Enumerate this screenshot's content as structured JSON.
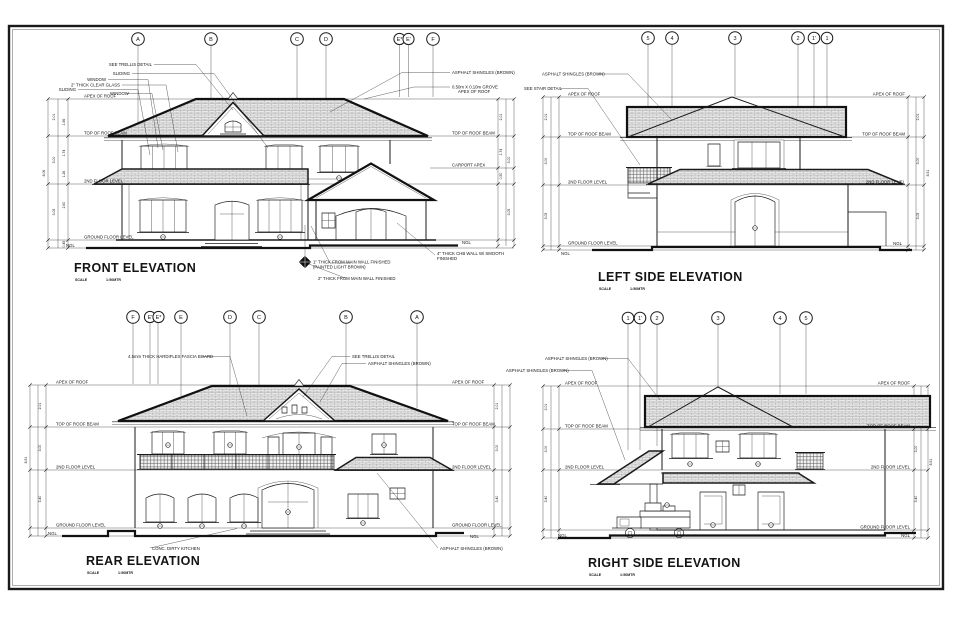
{
  "sheet": {
    "paper_color": "#ffffff",
    "line_color": "#1a1a1a"
  },
  "levels": {
    "apex_of_roof": "APEX OF ROOF",
    "top_of_roof_beam": "TOP OF ROOF BEAM",
    "carport_apex": "CARPORT APEX",
    "second_floor_level": "2ND FLOOR LEVEL",
    "ground_floor_level": "GROUND FLOOR LEVEL",
    "ngl": "NGL"
  },
  "notes": {
    "asphalt_shingles": "ASPHALT SHINGLES (BROWN)",
    "see_trellis": "SEE TRELLIS DETAIL",
    "see_stair": "SEE STAIR DETAIL",
    "sliding": "SLIDING",
    "window": "WINDOW",
    "clear_glass": "2\" THICK CLEAR GLASS",
    "grove": "0.50m X 0.10m GROVE",
    "grove_apex": "APEX OF ROOF",
    "fascia_board": "4.5mm THICK HARDIFLEX FASCIA BOARD",
    "dirty_kitchen": "CONC. DIRTY KITCHEN",
    "wall_note_1a": "1\" THICK FROM MAIN WALL FINISHED",
    "wall_note_1b": "(PAINTED LIGHT BROWN)",
    "wall_note_4a": "4\" THICK CHB WALL W/ SMOOTH",
    "wall_note_4b": "FINISHED",
    "wall_note_2": "2\" THICK FROM MAIN WALL FINISHED"
  },
  "front": {
    "title": "FRONT ELEVATION",
    "scale_label": "SCALE",
    "scale_value": "1:50MTR",
    "bubbles": [
      "A",
      "B",
      "C",
      "D",
      "E*",
      "E'",
      "F"
    ]
  },
  "left_side": {
    "title": "LEFT SIDE ELEVATION",
    "scale_label": "SCALE",
    "scale_value": "1:50MTR",
    "bubbles": [
      "5",
      "4",
      "3",
      "2",
      "1'",
      "1"
    ]
  },
  "rear": {
    "title": "REAR ELEVATION",
    "scale_label": "SCALE",
    "scale_value": "1:50MTR",
    "bubbles": [
      "F",
      "E'",
      "E*",
      "E",
      "D",
      "C",
      "B",
      "A"
    ]
  },
  "right_side": {
    "title": "RIGHT SIDE ELEVATION",
    "scale_label": "SCALE",
    "scale_value": "1:50MTR",
    "bubbles": [
      "1",
      "1'",
      "2",
      "3",
      "4",
      "5"
    ]
  },
  "dims": {
    "d045": "0.45",
    "d050": "0.50",
    "d100": "1.00",
    "d126": "1.26",
    "d140": "1.40",
    "d148": "1.48",
    "d156": "1.56",
    "d174": "1.74",
    "d201": "2.01",
    "d205": "2.05",
    "d260": "2.60",
    "d300": "3.00",
    "d305": "3.05",
    "d340": "3.40",
    "d806": "8.06",
    "d851": "8.51"
  }
}
